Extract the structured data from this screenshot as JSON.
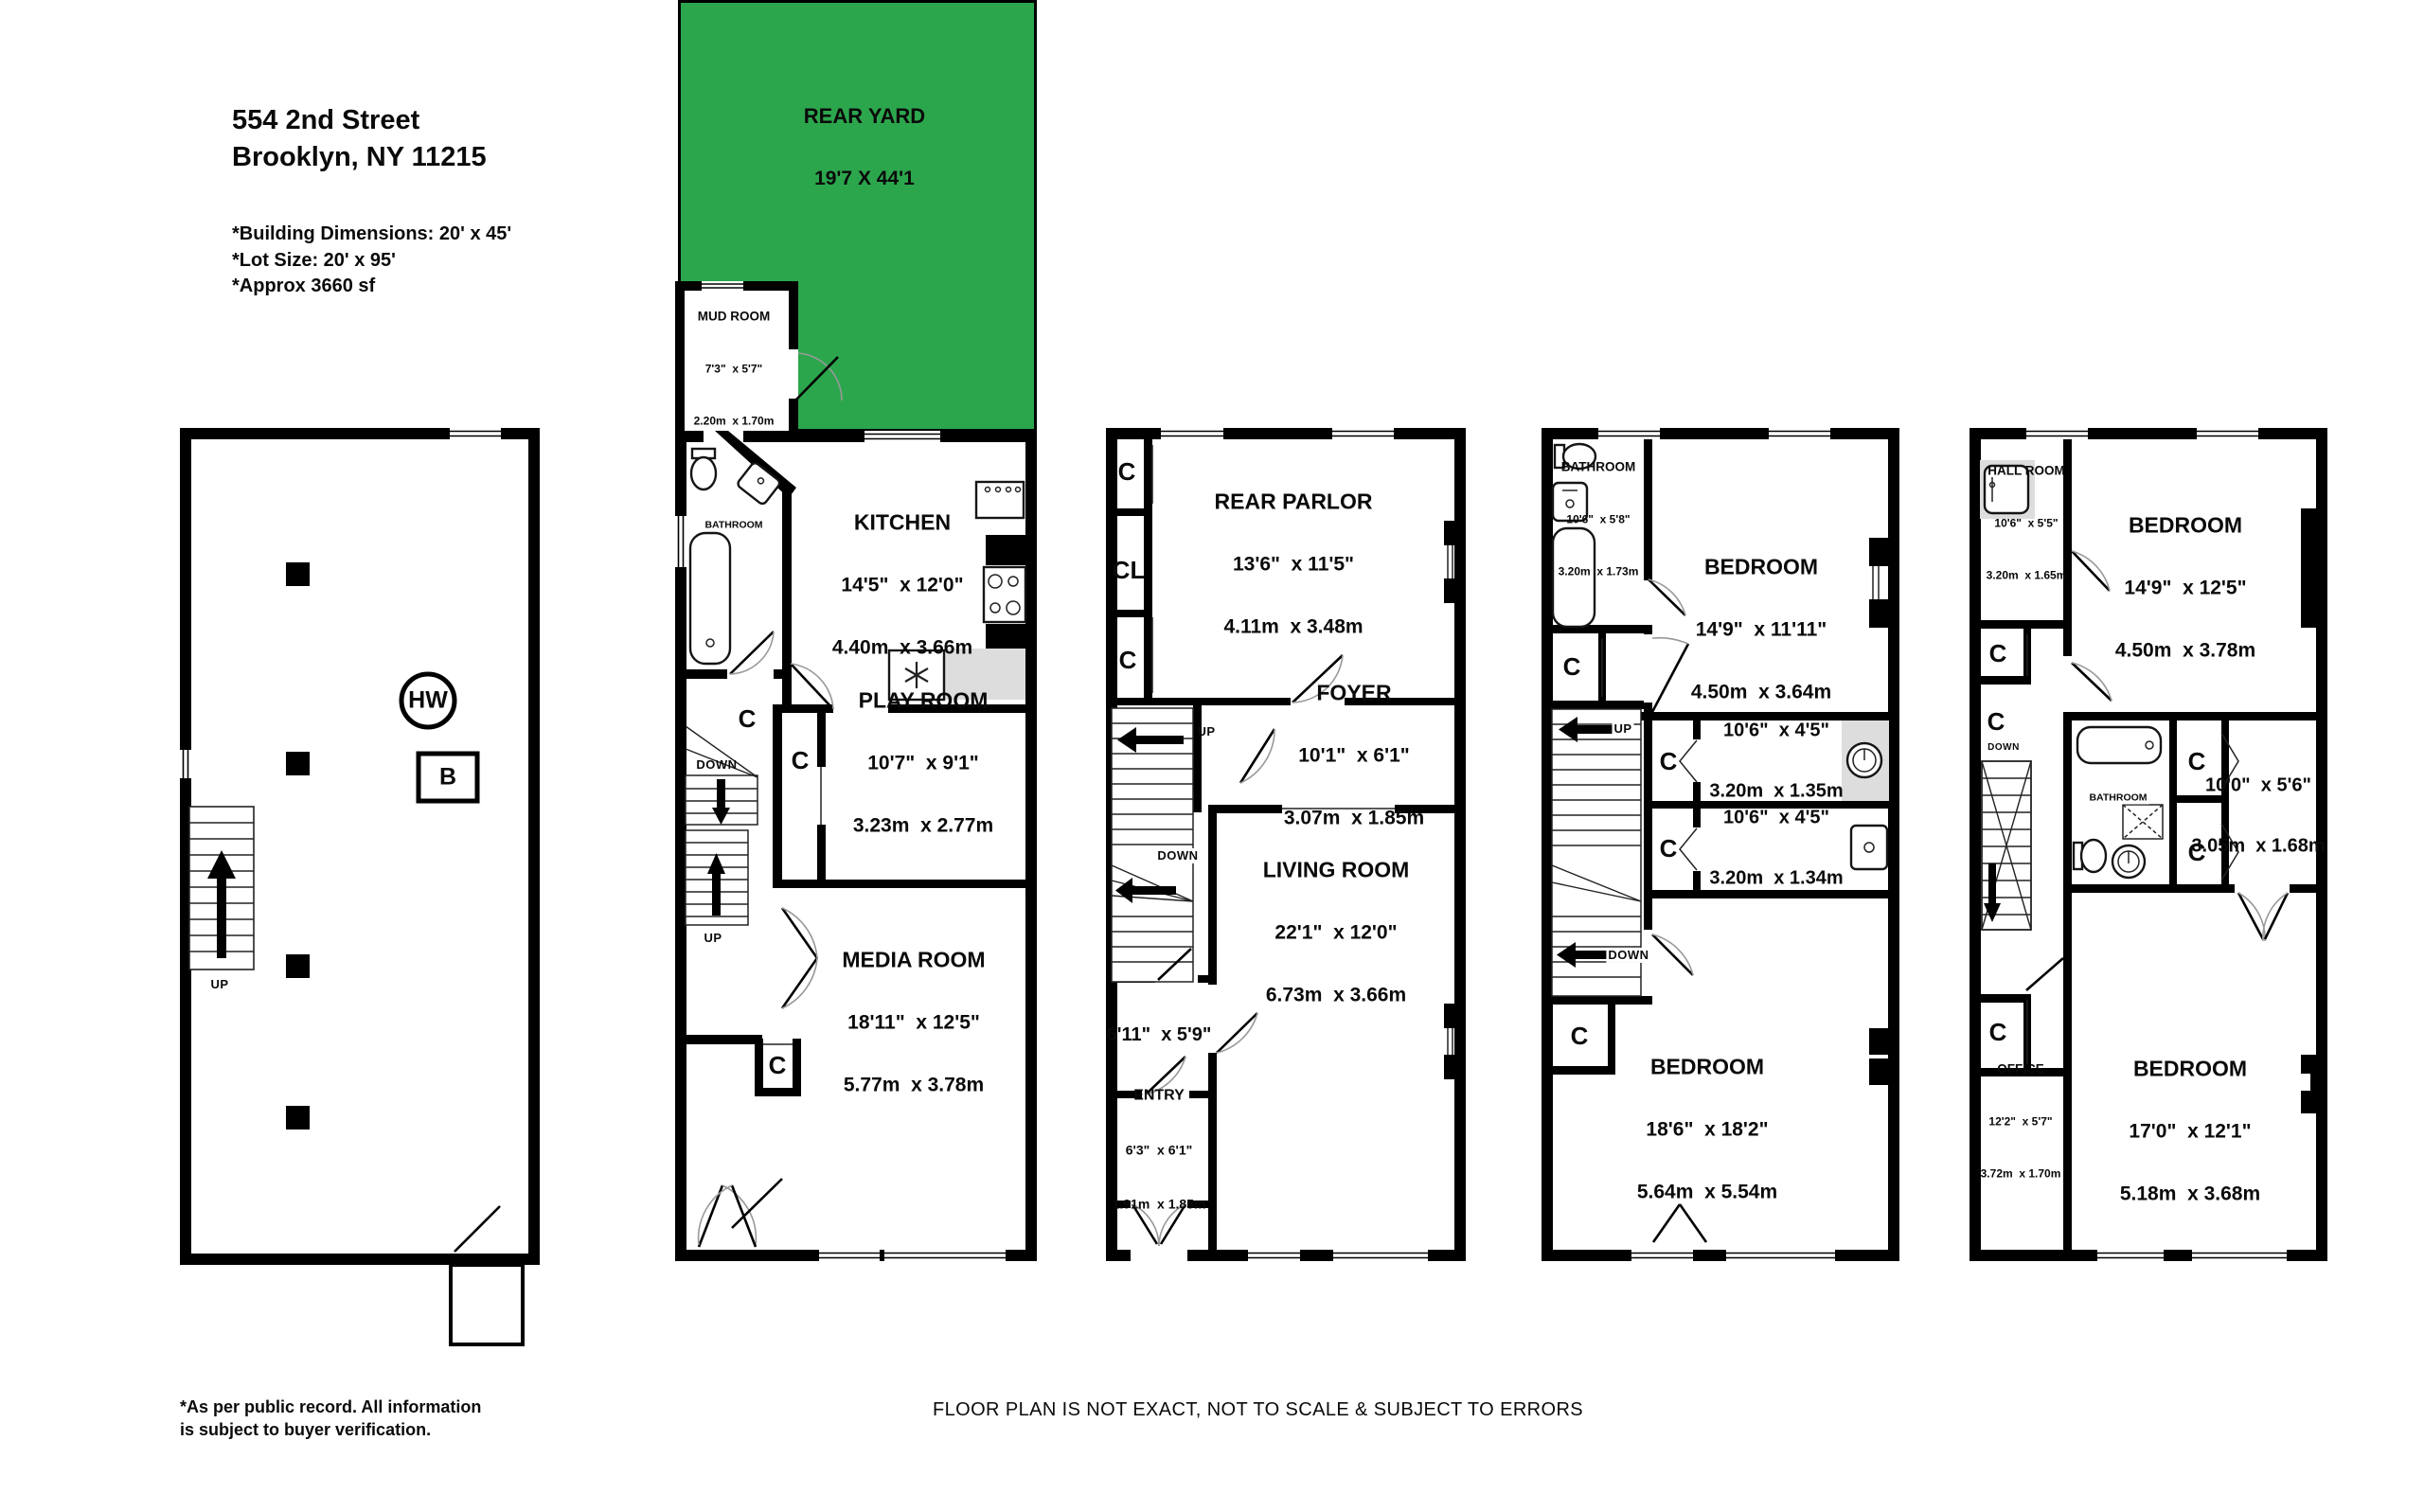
{
  "header": {
    "address_line1": "554 2nd Street",
    "address_line2": "Brooklyn, NY 11215",
    "note1": "*Building Dimensions: 20' x 45'",
    "note2": "*Lot Size: 20' x 95'",
    "note3": "*Approx 3660 sf"
  },
  "rear_yard": {
    "name": "REAR YARD",
    "dims": "19'7 X 44'1",
    "color": "#2ca64d"
  },
  "labels": {
    "closet": "C",
    "closet_long": "CL",
    "up": "UP",
    "down": "DOWN",
    "hot_water": "HW",
    "boiler": "B"
  },
  "garden": {
    "mud_room": {
      "name": "MUD ROOM",
      "imp": "7'3\"  x 5'7\"",
      "met": "2.20m  x 1.70m"
    },
    "bathroom": {
      "name": "BATHROOM"
    },
    "kitchen": {
      "name": "KITCHEN",
      "imp": "14'5\"  x 12'0\"",
      "met": "4.40m  x 3.66m"
    },
    "play_room": {
      "name": "PLAY ROOM",
      "imp": "10'7\"  x 9'1\"",
      "met": "3.23m  x 2.77m"
    },
    "media_room": {
      "name": "MEDIA ROOM",
      "imp": "18'11\"  x 12'5\"",
      "met": "5.77m  x 3.78m"
    }
  },
  "parlor": {
    "rear_parlor": {
      "name": "REAR PARLOR",
      "imp": "13'6\"  x 11'5\"",
      "met": "4.11m  x 3.48m"
    },
    "foyer": {
      "name": "FOYER",
      "imp": "10'1\"  x 6'1\"",
      "met": "3.07m  x 1.85m"
    },
    "living_room": {
      "name": "LIVING ROOM",
      "imp": "22'1\"  x 12'0\"",
      "met": "6.73m  x 3.66m"
    },
    "vestibule": {
      "imp": "6'11\"  x 5'9\""
    },
    "entry": {
      "name": "ENTRY",
      "imp": "6'3\"  x 6'1\"",
      "met": "1.91m  x 1.85m"
    }
  },
  "third_floor": {
    "bathroom": {
      "name": "BATHROOM",
      "imp": "10'6\"  x 5'8\"",
      "met": "3.20m  x 1.73m"
    },
    "bedroom_rear": {
      "name": "BEDROOM",
      "imp": "14'9\"  x 11'11\"",
      "met": "4.50m  x 3.64m"
    },
    "hall_room_a": {
      "imp": "10'6\"  x 4'5\"",
      "met": "3.20m  x 1.35m"
    },
    "hall_room_b": {
      "imp": "10'6\"  x 4'5\"",
      "met": "3.20m  x 1.34m"
    },
    "bedroom_front": {
      "name": "BEDROOM",
      "imp": "18'6\"  x 18'2\"",
      "met": "5.64m  x 5.54m"
    }
  },
  "fourth_floor": {
    "hall_room": {
      "name": "HALL ROOM",
      "imp": "10'6\"  x 5'5\"",
      "met": "3.20m  x 1.65m"
    },
    "bedroom_rear": {
      "name": "BEDROOM",
      "imp": "14'9\"  x 12'5\"",
      "met": "4.50m  x 3.78m"
    },
    "bathroom": {
      "name": "BATHROOM"
    },
    "hall_room_mid": {
      "imp": "10'0\"  x 5'6\"",
      "met": "3.05m  x 1.68m"
    },
    "office": {
      "name": "OFFICE",
      "imp": "12'2\"  x 5'7\"",
      "met": "3.72m  x 1.70m"
    },
    "bedroom_front": {
      "name": "BEDROOM",
      "imp": "17'0\"  x 12'1\"",
      "met": "5.18m  x 3.68m"
    }
  },
  "footer": {
    "left_line1": "*As per public record.  All information",
    "left_line2": "is subject to buyer verification.",
    "center": "FLOOR PLAN IS NOT EXACT, NOT TO SCALE & SUBJECT TO ERRORS"
  }
}
